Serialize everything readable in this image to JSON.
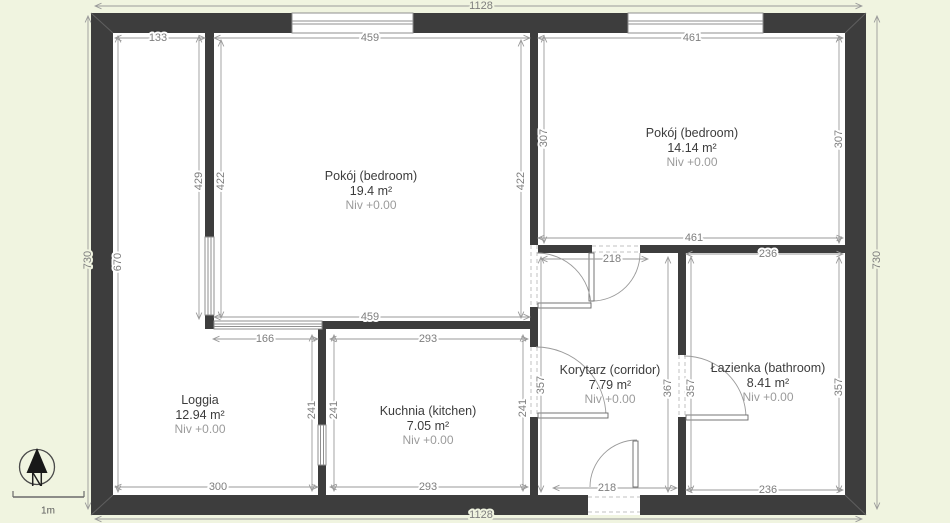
{
  "palette": {
    "background": "#f0f4e0",
    "wall": "#3d3d3d",
    "dimension": "#7e7e7e",
    "room_text": "#3c3c3c",
    "muted_text": "#9b9b9b"
  },
  "rooms": [
    {
      "id": "pokoj1",
      "name": "Pokój (bedroom)",
      "area": "19.4 m²",
      "level": "Niv +0.00"
    },
    {
      "id": "pokoj2",
      "name": "Pokój (bedroom)",
      "area": "14.14 m²",
      "level": "Niv +0.00"
    },
    {
      "id": "loggia",
      "name": "Loggia",
      "area": "12.94 m²",
      "level": "Niv +0.00"
    },
    {
      "id": "kuchnia",
      "name": "Kuchnia (kitchen)",
      "area": "7.05 m²",
      "level": "Niv +0.00"
    },
    {
      "id": "korytarz",
      "name": "Korytarz (corridor)",
      "area": "7.79 m²",
      "level": "Niv +0.00"
    },
    {
      "id": "lazienka",
      "name": "Łazienka (bathroom)",
      "area": "8.41 m²",
      "level": "Niv +0.00"
    }
  ],
  "dimensions": {
    "top_total": "1128",
    "top_loggia": "133",
    "top_pokoj1": "459",
    "top_pokoj2": "461",
    "left_total": "730",
    "left_inner": "670",
    "loggia_strip_height": "429",
    "pokoj1_height_left": "422",
    "pokoj1_height_right": "422",
    "pokoj2_height_left": "307",
    "pokoj2_height_right": "307",
    "right_total": "730",
    "pokoj2_bottom": "461",
    "corridor_door_top": "218",
    "bathroom_top": "236",
    "pokoj1_bottom": "459",
    "loggia_kitchen_gap": "166",
    "kitchen_top": "293",
    "loggia_height": "241",
    "kitchen_height_left": "241",
    "kitchen_height_right": "241",
    "corridor_height_left": "357",
    "corridor_height_right": "367",
    "bathroom_height_left": "357",
    "bathroom_height_right": "357",
    "bottom_loggia": "300",
    "bottom_kitchen": "293",
    "entrance_door": "218",
    "bottom_bathroom": "236",
    "bottom_total": "1128"
  },
  "compass": {
    "label": "N"
  },
  "scale_bar": {
    "label": "1m"
  }
}
